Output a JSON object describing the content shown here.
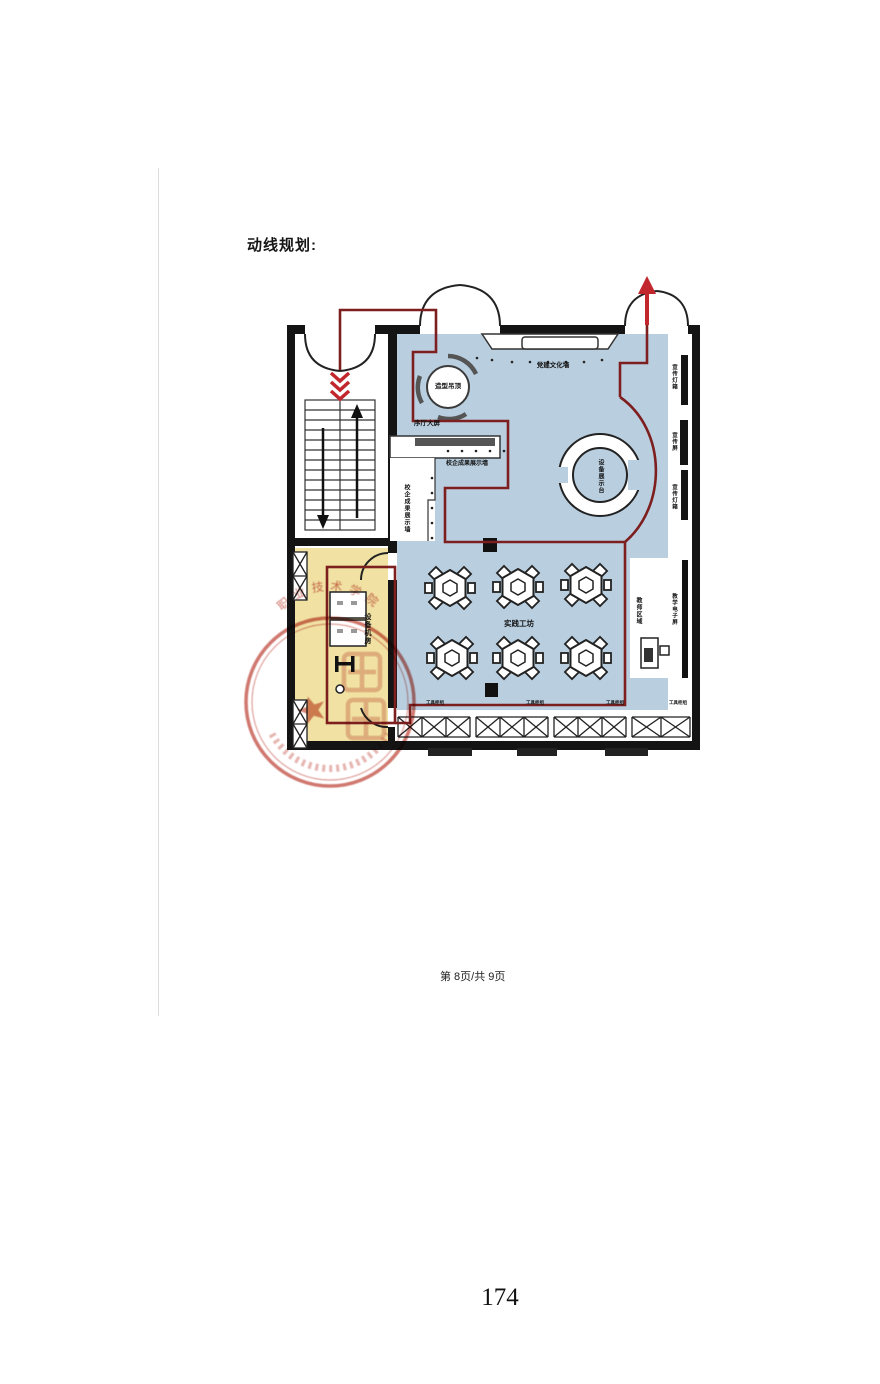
{
  "page": {
    "title": "动线规划:",
    "footer": "第 8页/共 9页",
    "page_number": "174"
  },
  "plan": {
    "type": "floor-plan-circulation-diagram",
    "colors": {
      "hall_fill": "#b9cfe0",
      "equipment_room_fill": "#f1e2a4",
      "wall": "#141414",
      "circulation_path": "#7e1f1f",
      "direction_arrow": "#c1272d",
      "stamp": "#c4564b"
    },
    "labels": {
      "shaped_ceiling": "造型吊顶",
      "lobby_screen": "序厅大屏",
      "achievement_wall_h": "校企成果展示墙",
      "achievement_wall_v": "校企成果展示墙",
      "party_culture_wall": "党建文化墙",
      "promo_lightbox_top": "宣传灯箱",
      "promo_screen": "宣传屏",
      "promo_lightbox_bottom": "宣传灯箱",
      "equipment_display": "设备展示台",
      "practice_workshop": "实践工坊",
      "teacher_area": "教师区域",
      "teaching_screen": "教学电子屏",
      "equipment_machine_room": "设备机房",
      "tool_cabinet_1": "工具柜组",
      "tool_cabinet_2": "工具柜组",
      "tool_cabinet_3": "工具柜组",
      "tool_cabinet_4": "工具柜组"
    },
    "stamp": {
      "shape": "circular-red-seal-with-star",
      "arc_text_visible_fragment": "职业技术学院",
      "legible": false
    }
  }
}
